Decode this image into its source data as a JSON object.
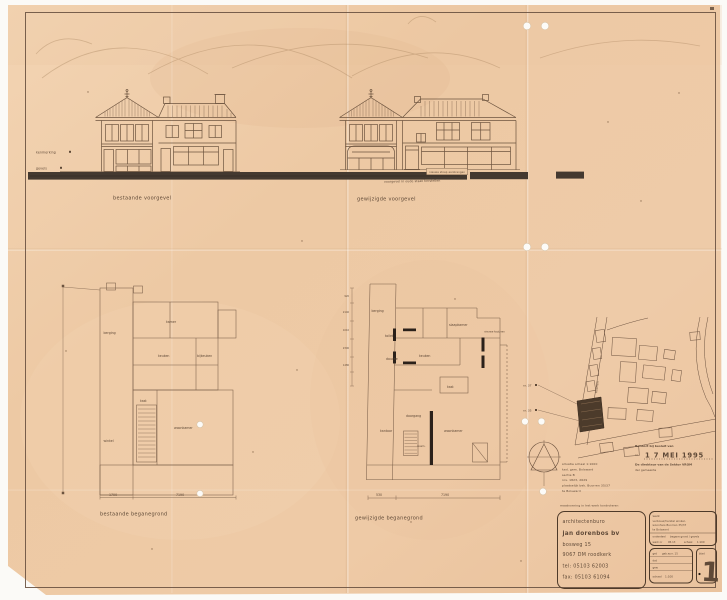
{
  "colors": {
    "paper": "#eec9a4",
    "ink": "#6b5342",
    "street_band": "#443930",
    "stamp_ink": "#4a3426"
  },
  "titles": {
    "elevation_existing": "bestaande voorgevel",
    "elevation_modified": "gewijzigde voorgevel",
    "plan_existing": "bestaande beganegrond",
    "plan_modified": "gewijzigde beganegrond"
  },
  "margin_notes": {
    "top": "kenmerking",
    "bottom": "gevels"
  },
  "facade_notes": {
    "band": "nieuwe stoep aanbrengen",
    "restore": "voorgevel in oude staat herstellen"
  },
  "plan_existing": {
    "rooms": {
      "berging": "berging",
      "kamer": "kamer",
      "keuken": "keuken",
      "bijkeuken": "bijkeuken",
      "kast": "kast",
      "winkel": "winkel",
      "woonkamer": "woonkamer"
    },
    "dim1": "1700",
    "dim2": "7190"
  },
  "plan_modified": {
    "rooms": {
      "berging": "berging",
      "toilet": "toilet",
      "douche": "douche",
      "slaapkamer": "slaapkamer",
      "keuken": "keuken",
      "kast": "kast",
      "doorgang": "doorgang",
      "kantoor": "kantoor",
      "woonkamer": "woonkamer",
      "was": "wasm."
    },
    "note_right": "nieuwe kozijnen",
    "dim1": "530",
    "dim2": "7190",
    "dims_left": [
      "920",
      "2140",
      "1010",
      "2300",
      "1480"
    ]
  },
  "site": {
    "street": "buorren",
    "nr_top": "nr. 37",
    "nr_bottom": "nr. 35"
  },
  "kadaster": [
    "situatie schaal 1:1000",
    "kad. gem. Bolsward",
    "sectie B",
    "nrs. 1823, 2629",
    "plaatselijk bek. Buorren 35/37",
    "te Bolsward"
  ],
  "check_note": "maatvoering in het werk kontroleren",
  "stamp": {
    "line1": "Behoort bij besluit van",
    "nr_label": "nr.",
    "date": "1 7 MEI 1995",
    "line2": "De direkteur van de Sektor VROM",
    "line3": "der gemeente"
  },
  "titleblock": {
    "architect": [
      "architectenburo",
      "jan dorenbos bv",
      "bosweg 15",
      "9067 DM roodkerk",
      "tel:   05103 62003",
      "fax:  05103 61094"
    ],
    "werk_label": "werk",
    "werk_lines": [
      "verbouw/herstel winkel-",
      "woonhuis Buorren 35/37",
      "te Bolsward"
    ],
    "onderdeel_label": "onderdeel",
    "onderdeel_value": "begane grond / gevels",
    "werknr_label": "werk nr",
    "werknr_value": "95.13",
    "schaal_label": "schaal",
    "schaal_value": "1:100",
    "get_label": "get",
    "get_value": "geb.w.nr. 15",
    "dat_label": "dat",
    "gew_label": "gew",
    "blad_label": "blad",
    "blad_value": "1"
  }
}
